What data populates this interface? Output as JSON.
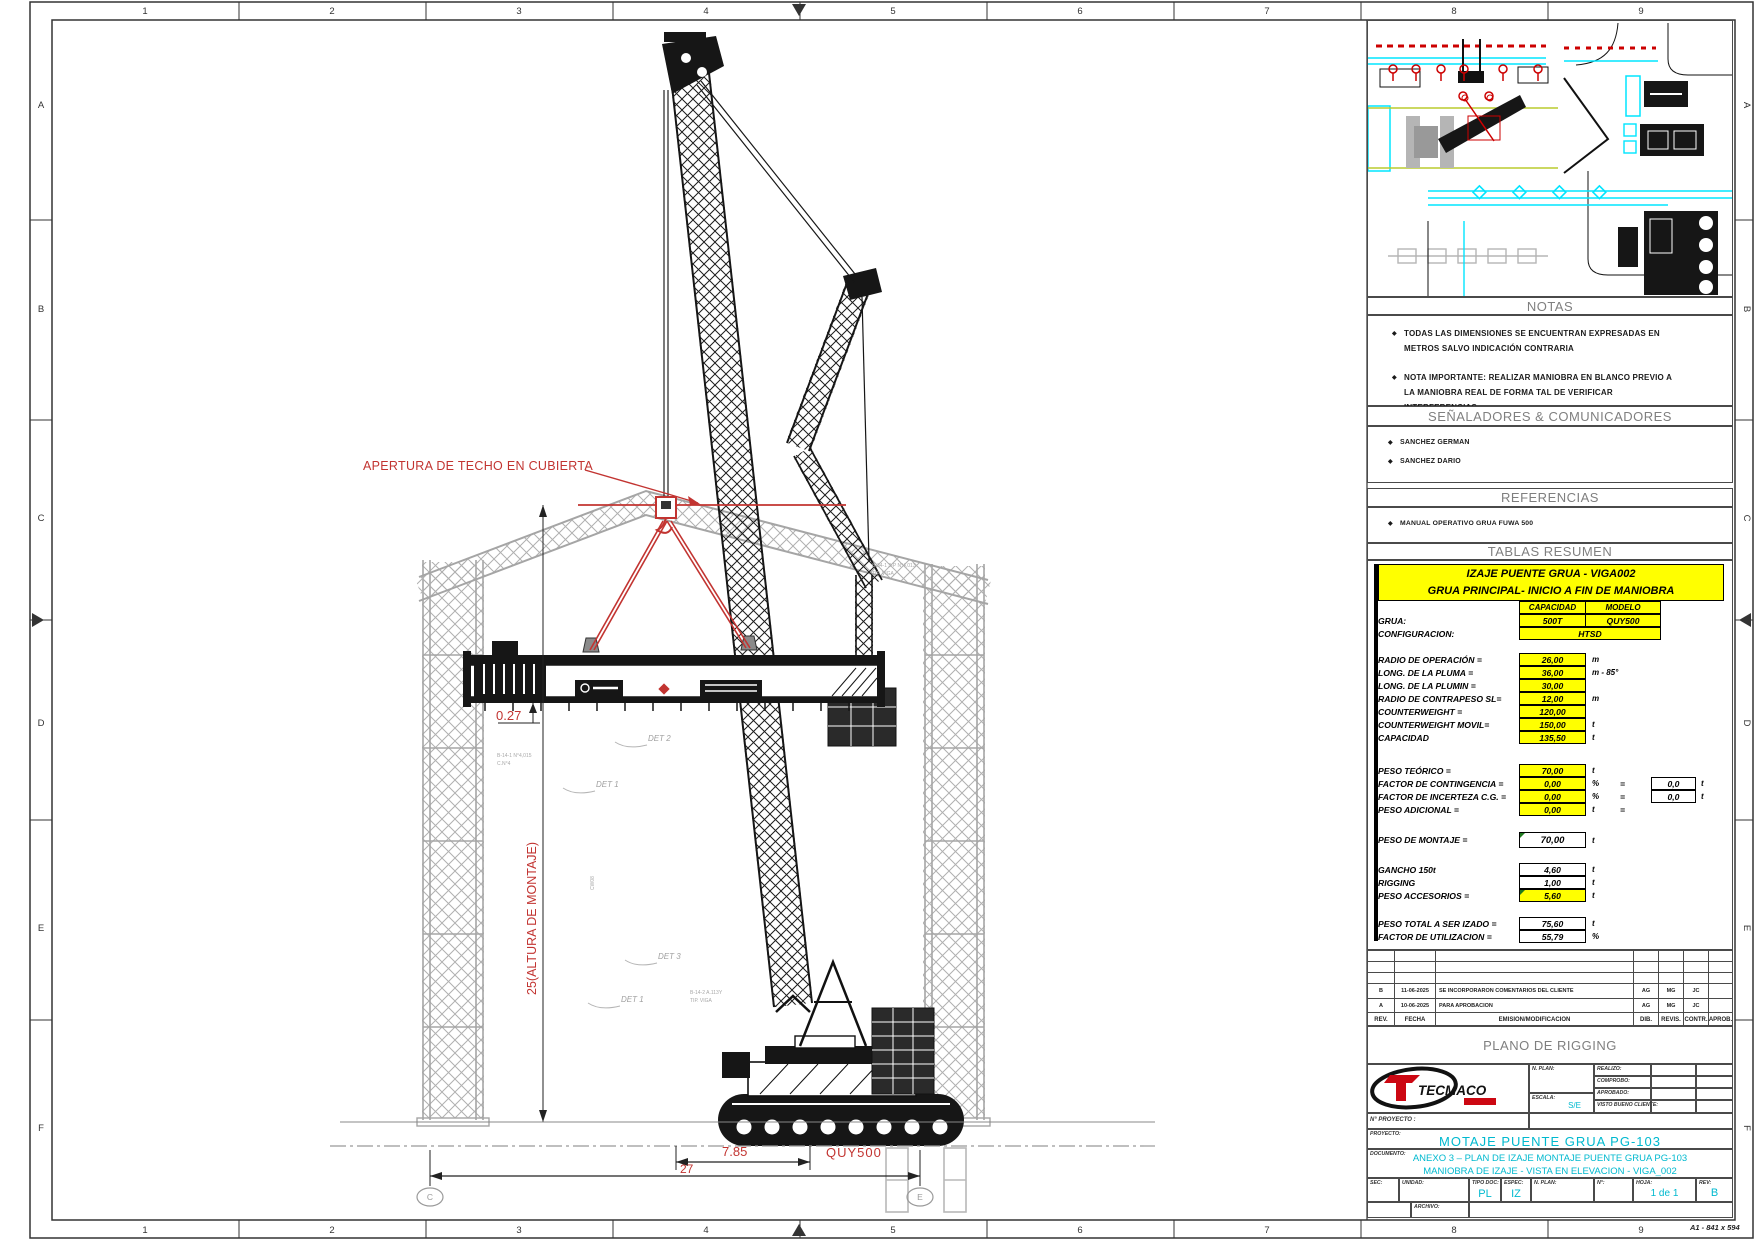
{
  "sheet": {
    "cols": [
      "1",
      "2",
      "3",
      "4",
      "5",
      "6",
      "7",
      "8",
      "9"
    ],
    "rows": [
      "A",
      "B",
      "C",
      "D",
      "E",
      "F"
    ],
    "format": "A1 - 841 x 594"
  },
  "drawing": {
    "apertura": "APERTURA DE TECHO EN CUBIERTA",
    "dim_027": "0.27",
    "dim_altura": "25(ALTURA DE MONTAJE)",
    "dim_785": "7.85",
    "dim_27": "27",
    "crane_model": "QUY500",
    "bubble_left": "C",
    "bubble_right": "E",
    "details": [
      "DET  2",
      "DET  1",
      "DET  3",
      "DET  1"
    ],
    "micro": [
      "B-14-1 N°4,015",
      "C.N°4",
      "B-34-1 3-P N°4,013",
      "TIP. VIGA",
      "B-14-2 A.113Y",
      "TIP. VIGA",
      "CW08"
    ]
  },
  "panel": {
    "notas": {
      "title": "NOTAS",
      "items": [
        "TODAS LAS DIMENSIONES SE ENCUENTRAN EXPRESADAS EN METROS SALVO INDICACIÓN CONTRARIA",
        "NOTA IMPORTANTE: REALIZAR MANIOBRA EN BLANCO PREVIO A LA MANIOBRA REAL DE FORMA TAL DE VERIFICAR INTERFERENCIAS."
      ]
    },
    "senaladores": {
      "title": "SEÑALADORES & COMUNICADORES",
      "items": [
        "SANCHEZ GERMAN",
        "SANCHEZ DARIO"
      ]
    },
    "referencias": {
      "title": "REFERENCIAS",
      "items": [
        "MANUAL OPERATIVO GRUA FUWA 500"
      ]
    },
    "tablas": {
      "title": "TABLAS RESUMEN",
      "t1": "IZAJE PUENTE GRUA - VIGA002",
      "t2": "GRUA PRINCIPAL-  INICIO A FIN DE MANIOBRA",
      "cap": "CAPACIDAD",
      "mod": "MODELO",
      "grua_l": "GRUA:",
      "grua_cap": "500T",
      "grua_mod": "QUY500",
      "conf_l": "CONFIGURACION:",
      "conf_v": "HTSD",
      "rows": {
        "radio": {
          "l": "RADIO DE OPERACIÓN =",
          "v": "26,00",
          "u": "m"
        },
        "pluma": {
          "l": "LONG. DE LA PLUMA =",
          "v": "36,00",
          "u": "m - 85°"
        },
        "plumin": {
          "l": "LONG. DE LA PLUMIN =",
          "v": "30,00",
          "u": ""
        },
        "rcont": {
          "l": "RADIO DE CONTRAPESO SL=",
          "v": "12,00",
          "u": "m"
        },
        "cw": {
          "l": "COUNTERWEIGHT  =",
          "v": "120,00",
          "u": ""
        },
        "cwm": {
          "l": "COUNTERWEIGHT  MOVIL=",
          "v": "150,00",
          "u": "t"
        },
        "cap": {
          "l": "CAPACIDAD",
          "v": "135,50",
          "u": "t"
        },
        "teorico": {
          "l": "PESO TEÓRICO =",
          "v": "70,00",
          "u": "t"
        },
        "cont": {
          "l": "FACTOR DE CONTINGENCIA =",
          "v": "0,00",
          "u": "%",
          "eq": "=",
          "r": "0,0",
          "ru": "t"
        },
        "incert": {
          "l": "FACTOR DE INCERTEZA C.G. =",
          "v": "0,00",
          "u": "%",
          "eq": "=",
          "r": "0,0",
          "ru": "t"
        },
        "adic": {
          "l": "PESO ADICIONAL =",
          "v": "0,00",
          "u": "t",
          "eq": "="
        },
        "montaje": {
          "l": "PESO DE MONTAJE =",
          "v": "70,00",
          "u": "t"
        },
        "gancho": {
          "l": "GANCHO 150t",
          "v": "4,60",
          "u": "t"
        },
        "rigging": {
          "l": "RIGGING",
          "v": "1,00",
          "u": "t"
        },
        "acces": {
          "l": "PESO ACCESORIOS =",
          "v": "5,60",
          "u": "t"
        },
        "total": {
          "l": "PESO TOTAL A SER IZADO =",
          "v": "75,60",
          "u": "t"
        },
        "util": {
          "l": "FACTOR DE UTILIZACION =",
          "v": "55,79",
          "u": "%"
        }
      }
    },
    "revisiones": {
      "headers": [
        "REV.",
        "FECHA",
        "EMISION/MODIFICACION",
        "DIB.",
        "REVIS.",
        "CONTR.",
        "APROB."
      ],
      "rows": [
        {
          "rev": "B",
          "fecha": "11-06-2025",
          "desc": "SE INCORPORARON COMENTARIOS DEL CLIENTE",
          "dib": "AG",
          "revis": "MG",
          "contr": "JC",
          "aprob": ""
        },
        {
          "rev": "A",
          "fecha": "10-06-2025",
          "desc": "PARA APROBACION",
          "dib": "AG",
          "revis": "MG",
          "contr": "JC",
          "aprob": ""
        }
      ]
    }
  },
  "titleblock": {
    "band": "PLANO DE RIGGING",
    "logo": "TECMACO",
    "labels": {
      "nplan": "N. PLAN:",
      "escala": "ESCALA:",
      "realizo": "REALIZO:",
      "comprobo": "COMPROBO:",
      "aprobado": "APROBADO:",
      "visto": "VISTO BUENO CLIENTE:",
      "nproyecto": "N° PROYECTO :",
      "proyecto": "PROYECTO:",
      "documento": "DOCUMENTO:",
      "sec": "SEC:",
      "unidad": "UNIDAD:",
      "tipodoc": "TIPO DOC:",
      "espec": "ESPEC:",
      "nplan2": "N. PLAN:",
      "n": "N°:",
      "hoja": "HOJA:",
      "rev": "REV:",
      "archivo": "ARCHIVO:"
    },
    "values": {
      "escala": "S/E",
      "proyecto": "MOTAJE PUENTE GRUA PG-103",
      "doc1": "ANEXO 3 – PLAN DE IZAJE MONTAJE PUENTE GRUA PG-103",
      "doc2": "MANIOBRA DE IZAJE - VISTA EN ELEVACION - VIGA_002",
      "tipodoc": "PL",
      "espec": "IZ",
      "hoja": "1 de 1",
      "rev": "B"
    }
  },
  "colors": {
    "red": "#c23431",
    "cyan": "#00b9cf",
    "yellow": "#ffff00",
    "gray_struct": "#ababab"
  }
}
